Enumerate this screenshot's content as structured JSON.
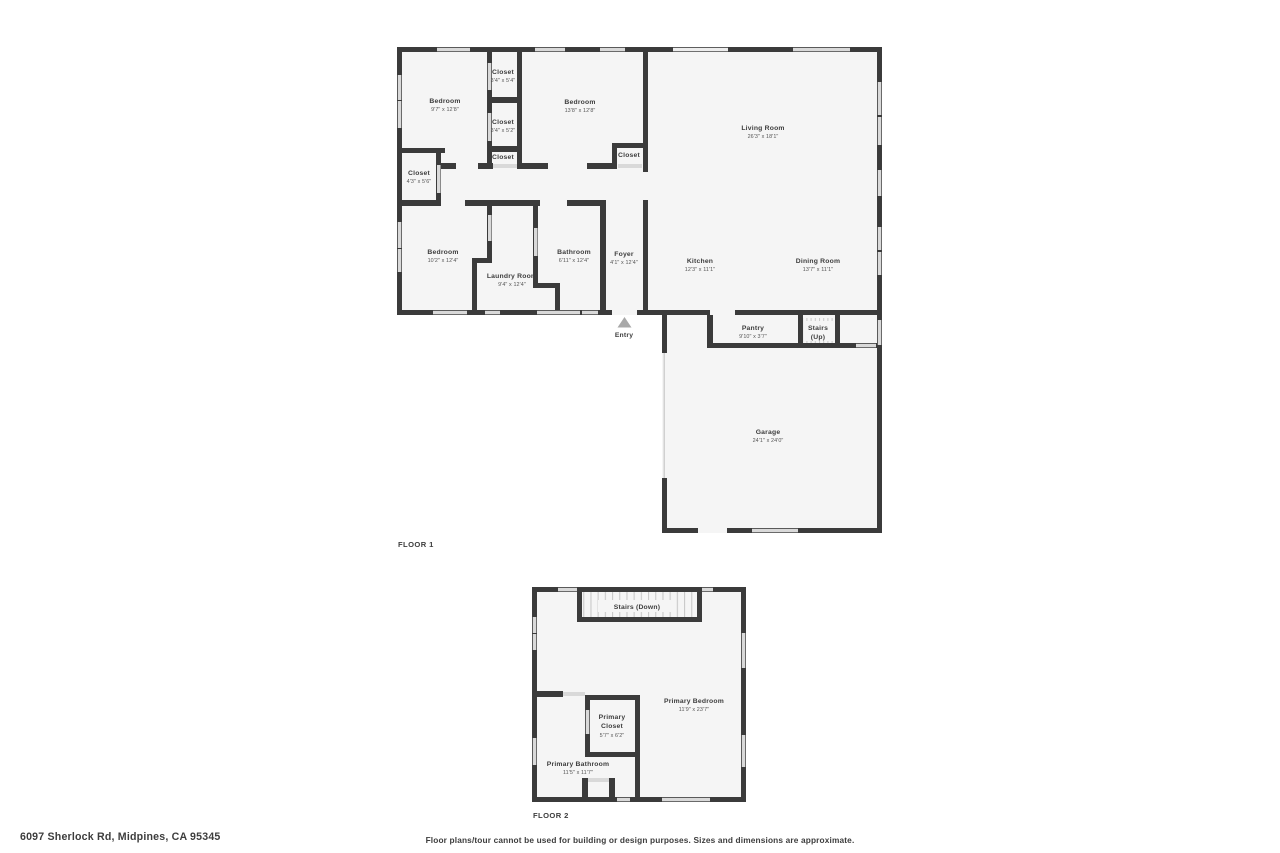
{
  "page": {
    "address": "6097 Sherlock Rd, Midpines, CA 95345",
    "disclaimer": "Floor plans/tour cannot be used for building or design purposes. Sizes and dimensions are approximate."
  },
  "colors": {
    "wall": "#3b3b3b",
    "room_fill": "#f5f5f5",
    "window": "#d9d9d9",
    "text": "#3d3d3d",
    "entry_marker": "#a8a8a8",
    "stair_tread": "#c9c9c9"
  },
  "floor1": {
    "label": "FLOOR 1",
    "entry_label": "Entry",
    "rooms": {
      "bedroom1": {
        "name": "Bedroom",
        "dims": "9'7\" x 12'8\""
      },
      "closet_a": {
        "name": "Closet",
        "dims": "3'4\" x 5'4\""
      },
      "closet_b": {
        "name": "Closet",
        "dims": "3'4\" x 5'2\""
      },
      "closet_hall": {
        "name": "Closet"
      },
      "bedroom2": {
        "name": "Bedroom",
        "dims": "13'8\" x 12'8\""
      },
      "closet_bedroom2": {
        "name": "Closet"
      },
      "closet_left": {
        "name": "Closet",
        "dims": "4'3\" x 5'6\""
      },
      "living_room": {
        "name": "Living Room",
        "dims": "26'3\" x 18'1\""
      },
      "bedroom3": {
        "name": "Bedroom",
        "dims": "10'2\" x 12'4\""
      },
      "laundry": {
        "name": "Laundry Room",
        "dims": "9'4\" x 12'4\""
      },
      "bathroom": {
        "name": "Bathroom",
        "dims": "6'11\" x 12'4\""
      },
      "foyer": {
        "name": "Foyer",
        "dims": "4'1\" x 12'4\""
      },
      "kitchen": {
        "name": "Kitchen",
        "dims": "12'3\" x 11'1\""
      },
      "dining_room": {
        "name": "Dining Room",
        "dims": "13'7\" x 11'1\""
      },
      "pantry": {
        "name": "Pantry",
        "dims": "9'10\" x 3'7\""
      },
      "stairs_up_line1": {
        "name": "Stairs"
      },
      "stairs_up_line2": {
        "name": "(Up)"
      },
      "garage": {
        "name": "Garage",
        "dims": "24'1\" x 24'0\""
      }
    }
  },
  "floor2": {
    "label": "FLOOR 2",
    "rooms": {
      "stairs_down": {
        "name": "Stairs (Down)"
      },
      "primary_bedroom": {
        "name": "Primary Bedroom",
        "dims": "11'9\" x 23'7\""
      },
      "primary_closet_line1": {
        "name": "Primary"
      },
      "primary_closet_line2": {
        "name": "Closet"
      },
      "primary_closet_dims": {
        "dims": "5'7\" x 6'2\""
      },
      "primary_bathroom": {
        "name": "Primary Bathroom",
        "dims": "11'5\" x 11'7\""
      }
    }
  }
}
